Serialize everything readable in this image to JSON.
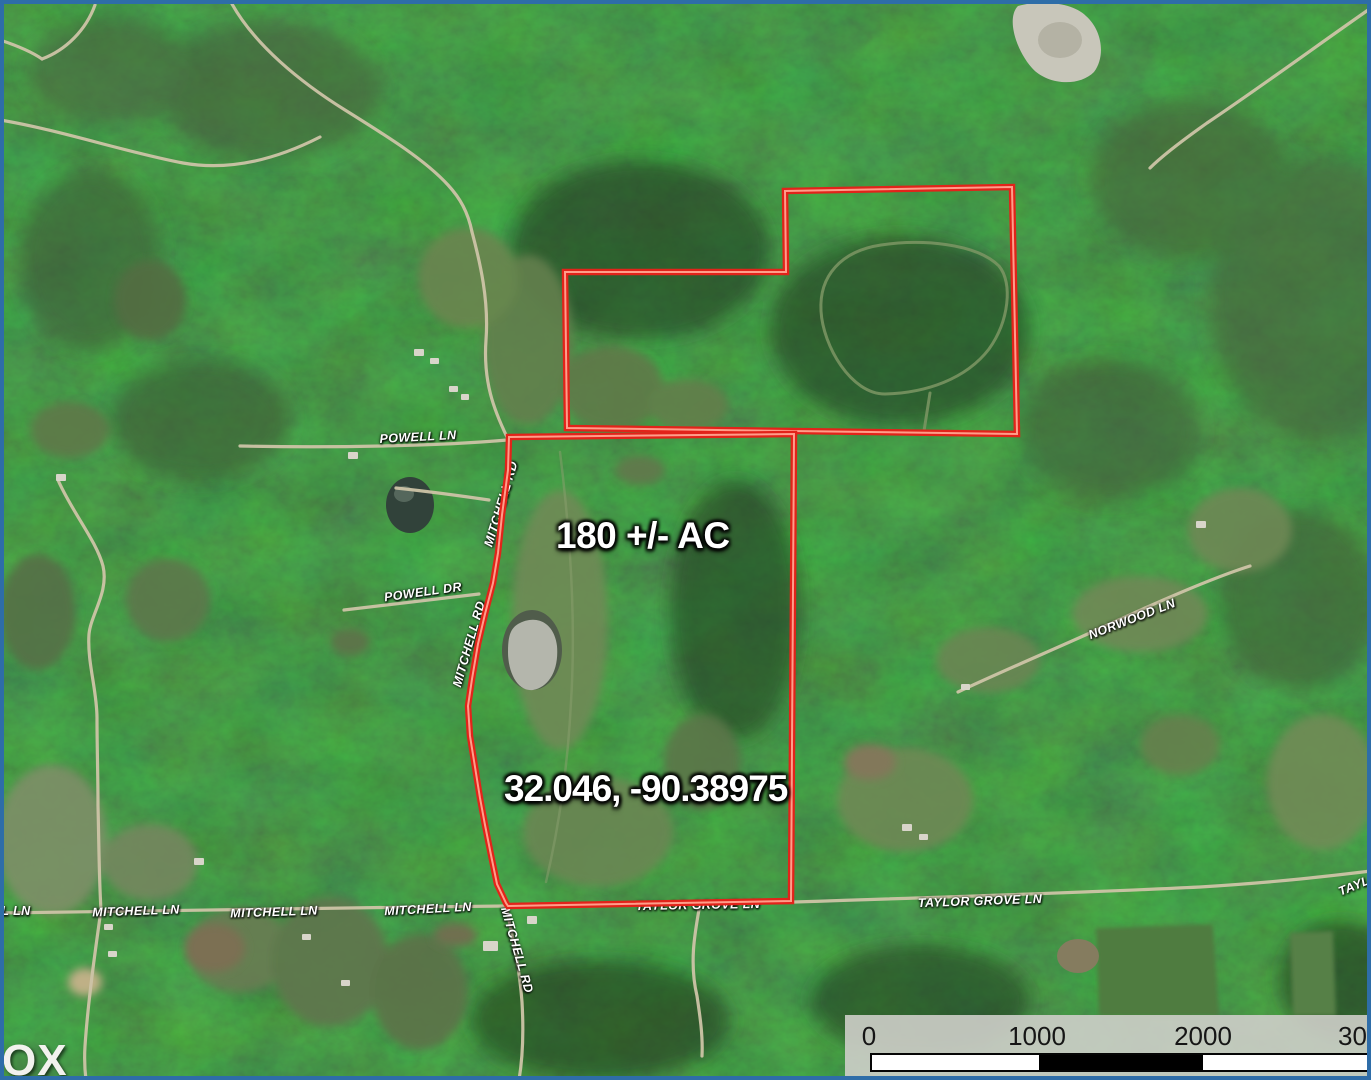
{
  "map": {
    "labels": {
      "acreage": "180 +/- AC",
      "coordinates": "32.046, -90.38975",
      "watermark": "OX"
    },
    "road_labels": [
      {
        "text": "POWELL LN",
        "x": 418,
        "y": 437,
        "rot": -3
      },
      {
        "text": "MITCHELL RD",
        "x": 501,
        "y": 504,
        "rot": -73
      },
      {
        "text": "POWELL DR",
        "x": 423,
        "y": 592,
        "rot": -8
      },
      {
        "text": "MITCHELL RD",
        "x": 469,
        "y": 644,
        "rot": -74
      },
      {
        "text": "NORWOOD LN",
        "x": 1132,
        "y": 619,
        "rot": -21
      },
      {
        "text": "L LN",
        "x": 16,
        "y": 911,
        "rot": 0
      },
      {
        "text": "MITCHELL LN",
        "x": 136,
        "y": 911,
        "rot": -2
      },
      {
        "text": "MITCHELL LN",
        "x": 274,
        "y": 912,
        "rot": -2
      },
      {
        "text": "MITCHELL LN",
        "x": 428,
        "y": 909,
        "rot": -3
      },
      {
        "text": "TAYLOR GROVE LN",
        "x": 698,
        "y": 905,
        "rot": -1
      },
      {
        "text": "TAYLOR GROVE LN",
        "x": 980,
        "y": 901,
        "rot": -2
      },
      {
        "text": "MITCHELL RD",
        "x": 517,
        "y": 950,
        "rot": 74
      },
      {
        "text": "TAYL",
        "x": 1354,
        "y": 886,
        "rot": -22
      }
    ],
    "scale_bar": {
      "ticks": [
        "0",
        "1000",
        "2000",
        "30"
      ]
    },
    "colors": {
      "boundary_red": "#e2231a",
      "boundary_core": "#ff9e8a",
      "frame_blue": "#2e6da8",
      "scale_panel": "#cecec9",
      "label_white": "#ffffff"
    }
  }
}
